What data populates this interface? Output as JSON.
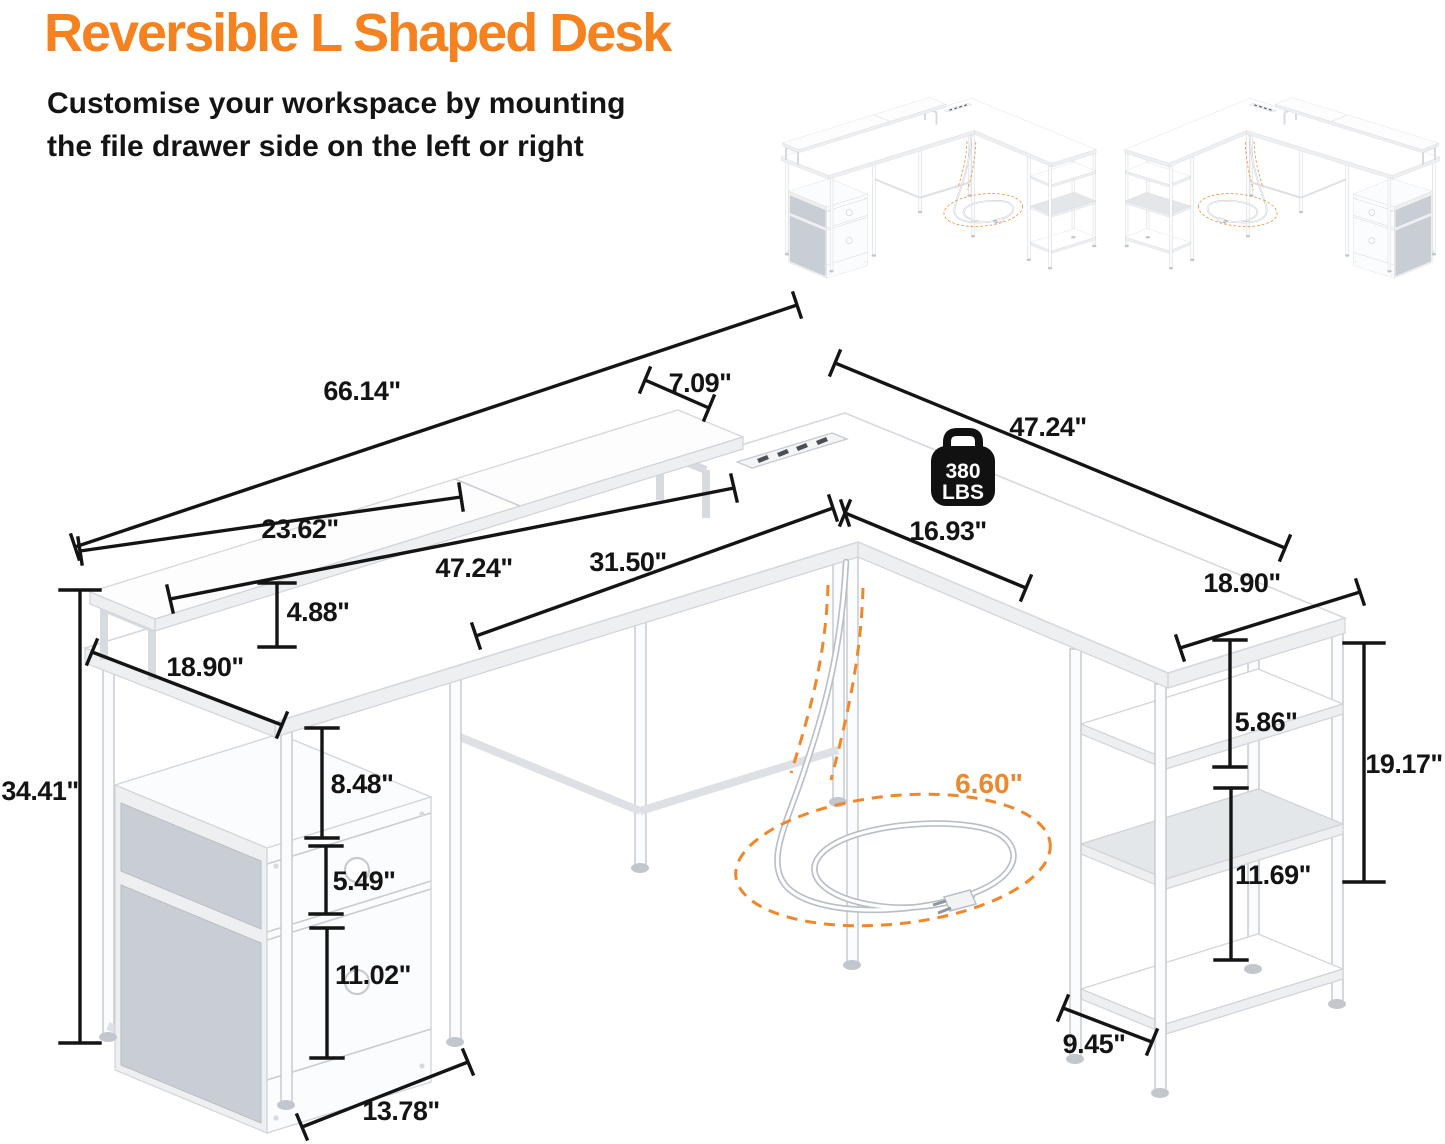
{
  "header": {
    "title": "Reversible L Shaped Desk",
    "subtitle_line1": "Customise your workspace by mounting",
    "subtitle_line2": "the file drawer side on the left or right"
  },
  "diagram": {
    "weight_badge": {
      "value": "380",
      "unit": "LBS"
    },
    "cord": {
      "length_label": "6.60\""
    },
    "dimensions": {
      "total_length": "66.14\"",
      "monitor_shelf_depth": "7.09\"",
      "right_desk_length": "47.24\"",
      "monitor_shelf_left_segment": "23.62\"",
      "left_desktop_length": "47.24\"",
      "knee_space_width": "31.50\"",
      "right_inner_edge": "16.93\"",
      "right_desk_depth": "18.90\"",
      "monitor_shelf_height": "4.88\"",
      "left_desk_depth": "18.90\"",
      "overall_height": "34.41\"",
      "drawer_clearance_height": "8.48\"",
      "top_drawer_height": "5.49\"",
      "file_drawer_height": "11.02\"",
      "drawer_unit_width": "13.78\"",
      "upper_shelf_spacing": "5.86\"",
      "shelf_section_height": "19.17\"",
      "lower_shelf_spacing": "11.69\"",
      "shelf_depth": "9.45\""
    },
    "colors": {
      "accent": "#F5821F",
      "dimension_line": "#141414"
    }
  }
}
